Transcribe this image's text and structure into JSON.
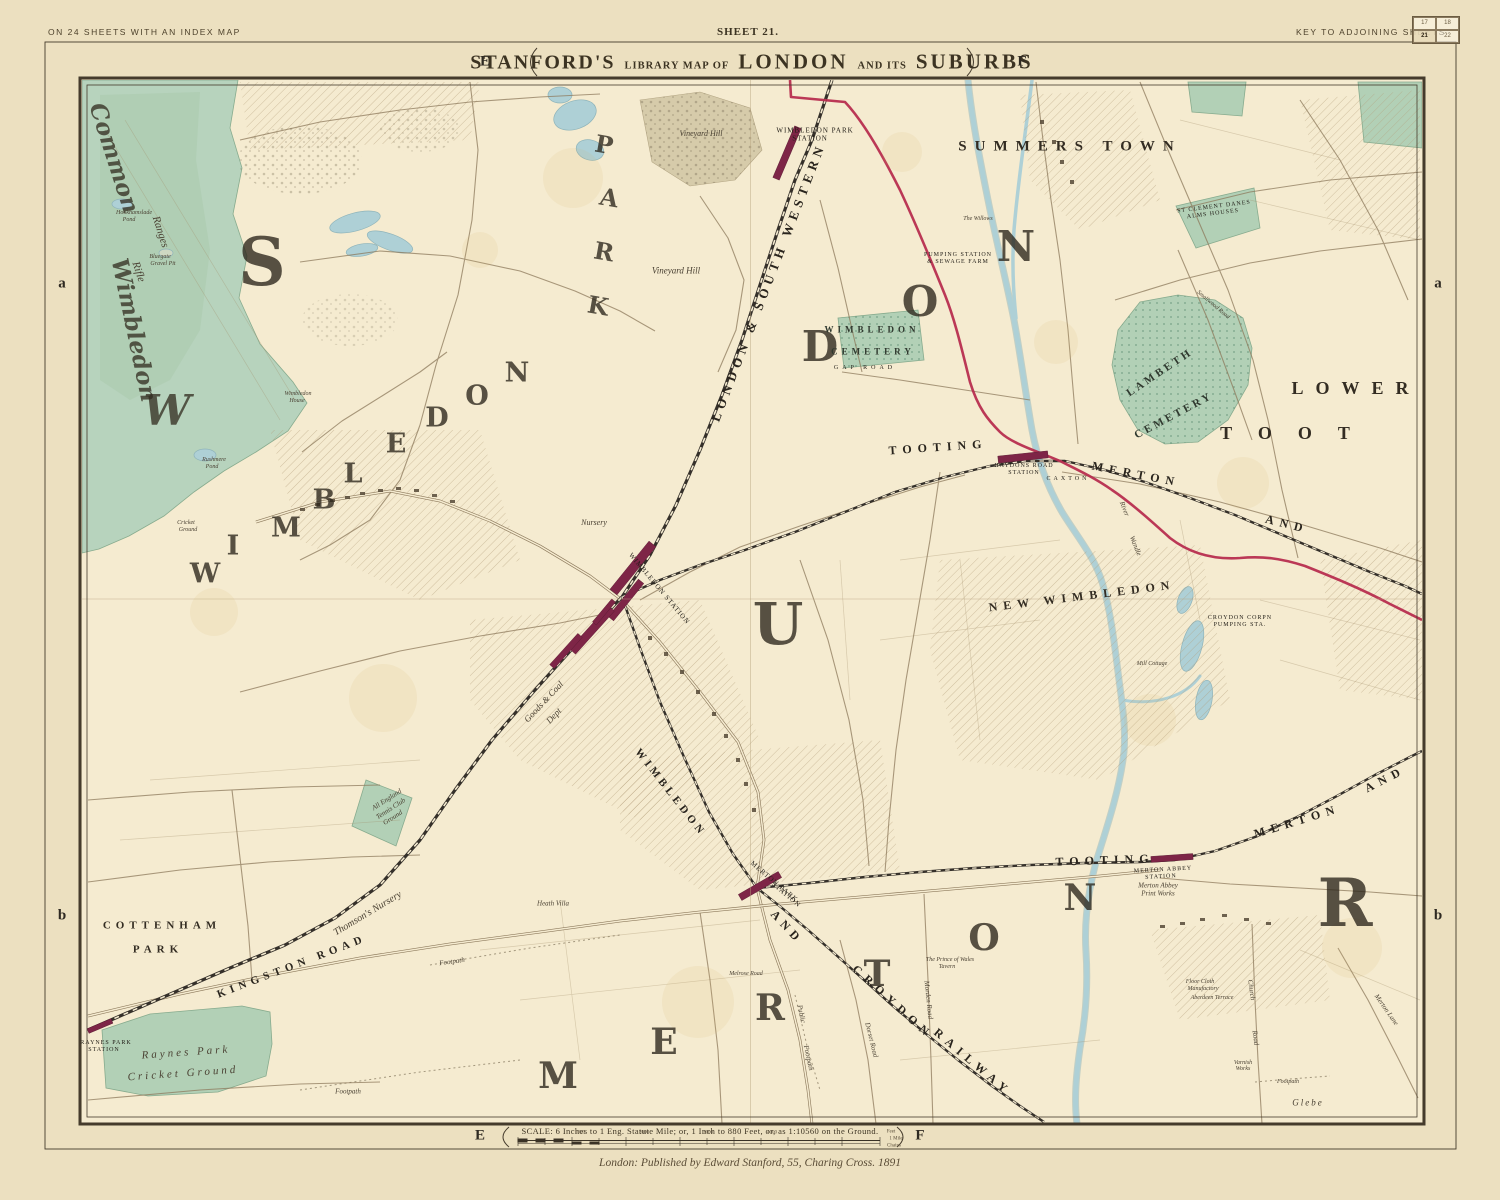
{
  "page": {
    "margin_top_left": "ON 24 SHEETS WITH AN INDEX MAP",
    "sheet_label": "SHEET 21.",
    "key_label": "KEY TO ADJOINING SHEETS",
    "key_grid": [
      "17",
      "18",
      "21",
      "22"
    ],
    "title": {
      "part1": "STANFORD'S",
      "part2": "LIBRARY MAP OF",
      "part3": "LONDON",
      "part4": "AND ITS",
      "part5": "SUBURBS"
    },
    "grid_letters": {
      "top_left": "E",
      "top_right": "F",
      "bottom_left": "E",
      "bottom_right": "F",
      "side_upper_left": "a",
      "side_upper_right": "a",
      "side_lower_left": "b",
      "side_lower_right": "b"
    },
    "scale_text": "SCALE: 6 Inches to 1 Eng. Statute Mile; or, 1 Inch to 880 Feet, or, as 1:10560 on the Ground.",
    "imprint": "London: Published by Edward Stanford, 55, Charing Cross. 1891"
  },
  "colors": {
    "paper": "#ece0c0",
    "map_paper": "#f5ebd0",
    "green": "#b2d0b6",
    "common_green": "#b7d3bd",
    "water": "#aed0d6",
    "boundary_red": "#b5284b",
    "station_maroon": "#7e2547",
    "railway_black": "#35302a",
    "ink": "#3d3528",
    "road": "#8d7a5c"
  },
  "map": {
    "labels": [
      {
        "t": "Common",
        "x": 114,
        "y": 158,
        "s": 23,
        "r": 72,
        "c": "hgi"
      },
      {
        "t": "Wimbledon",
        "x": 134,
        "y": 330,
        "s": 23,
        "r": 78,
        "c": "hgi"
      },
      {
        "t": "Rifle",
        "x": 138,
        "y": 272,
        "s": 11,
        "r": 72,
        "c": "i"
      },
      {
        "t": "Ranges",
        "x": 160,
        "y": 232,
        "s": 11,
        "r": 72,
        "c": "i"
      },
      {
        "t": "Hookhamslade",
        "x": 134,
        "y": 213,
        "s": 6,
        "c": "i"
      },
      {
        "t": "Pond",
        "x": 129,
        "y": 220,
        "s": 6,
        "c": "i"
      },
      {
        "t": "Bluegate",
        "x": 160,
        "y": 257,
        "s": 6,
        "c": "i"
      },
      {
        "t": "Gravel Pit",
        "x": 163,
        "y": 264,
        "s": 6,
        "c": "i"
      },
      {
        "t": "Rushmere",
        "x": 214,
        "y": 460,
        "s": 6,
        "c": "i"
      },
      {
        "t": "Pond",
        "x": 212,
        "y": 467,
        "s": 6,
        "c": "i"
      },
      {
        "t": "Cricket",
        "x": 186,
        "y": 523,
        "s": 6,
        "c": "i"
      },
      {
        "t": "Ground",
        "x": 188,
        "y": 530,
        "s": 6,
        "c": "i"
      },
      {
        "t": "S",
        "x": 262,
        "y": 262,
        "s": 66,
        "c": "hg",
        "n": "giant-letter"
      },
      {
        "t": "W",
        "x": 167,
        "y": 411,
        "s": 42,
        "c": "hgi",
        "n": "giant-letter"
      },
      {
        "t": "P",
        "x": 604,
        "y": 145,
        "s": 24,
        "r": 10,
        "c": "hg",
        "n": "giant-letter"
      },
      {
        "t": "A",
        "x": 609,
        "y": 198,
        "s": 24,
        "r": 10,
        "c": "hg",
        "n": "giant-letter"
      },
      {
        "t": "R",
        "x": 604,
        "y": 252,
        "s": 24,
        "r": 10,
        "c": "hg",
        "n": "giant-letter"
      },
      {
        "t": "K",
        "x": 598,
        "y": 306,
        "s": 24,
        "r": 10,
        "c": "hg",
        "n": "giant-letter"
      },
      {
        "t": "W",
        "x": 205,
        "y": 574,
        "s": 27,
        "c": "hg",
        "n": "giant-letter"
      },
      {
        "t": "I",
        "x": 233,
        "y": 546,
        "s": 27,
        "c": "hg",
        "n": "giant-letter"
      },
      {
        "t": "M",
        "x": 286,
        "y": 528,
        "s": 27,
        "c": "hg",
        "n": "giant-letter"
      },
      {
        "t": "B",
        "x": 324,
        "y": 500,
        "s": 27,
        "c": "hg",
        "n": "giant-letter"
      },
      {
        "t": "L",
        "x": 353,
        "y": 474,
        "s": 27,
        "c": "hg",
        "n": "giant-letter"
      },
      {
        "t": "E",
        "x": 396,
        "y": 444,
        "s": 27,
        "c": "hg",
        "n": "giant-letter"
      },
      {
        "t": "D",
        "x": 437,
        "y": 418,
        "s": 27,
        "c": "hg",
        "n": "giant-letter"
      },
      {
        "t": "O",
        "x": 477,
        "y": 396,
        "s": 27,
        "c": "hg",
        "n": "giant-letter"
      },
      {
        "t": "N",
        "x": 517,
        "y": 373,
        "s": 27,
        "c": "hg",
        "n": "giant-letter"
      },
      {
        "t": "U",
        "x": 778,
        "y": 624,
        "s": 58,
        "c": "hg",
        "n": "giant-letter"
      },
      {
        "t": "D",
        "x": 820,
        "y": 347,
        "s": 42,
        "c": "hg",
        "n": "giant-letter"
      },
      {
        "t": "O",
        "x": 920,
        "y": 302,
        "s": 42,
        "c": "hg",
        "n": "giant-letter"
      },
      {
        "t": "N",
        "x": 1016,
        "y": 247,
        "s": 42,
        "c": "hg",
        "n": "giant-letter"
      },
      {
        "t": "R",
        "x": 1345,
        "y": 903,
        "s": 66,
        "c": "hg",
        "n": "giant-letter"
      },
      {
        "t": "M",
        "x": 558,
        "y": 1076,
        "s": 36,
        "c": "hg",
        "n": "giant-letter"
      },
      {
        "t": "E",
        "x": 664,
        "y": 1042,
        "s": 36,
        "c": "hg",
        "n": "giant-letter"
      },
      {
        "t": "R",
        "x": 770,
        "y": 1008,
        "s": 36,
        "c": "hg",
        "n": "giant-letter"
      },
      {
        "t": "T",
        "x": 877,
        "y": 974,
        "s": 36,
        "c": "hg",
        "n": "giant-letter"
      },
      {
        "t": "O",
        "x": 984,
        "y": 938,
        "s": 36,
        "c": "hg",
        "n": "giant-letter"
      },
      {
        "t": "N",
        "x": 1080,
        "y": 898,
        "s": 36,
        "c": "hg",
        "n": "giant-letter"
      },
      {
        "t": "SUMMERS TOWN",
        "x": 1070,
        "y": 147,
        "s": 15,
        "c": "sp",
        "ls": 8
      },
      {
        "t": "LOWER",
        "x": 1356,
        "y": 388,
        "s": 18,
        "c": "sp",
        "ls": 12
      },
      {
        "t": "TOOT",
        "x": 1298,
        "y": 433,
        "s": 18,
        "c": "sp",
        "ls": 26
      },
      {
        "t": "NEW WIMBLEDON",
        "x": 1082,
        "y": 596,
        "s": 12,
        "r": -7,
        "c": "sp",
        "ls": 6
      },
      {
        "t": "COTTENHAM",
        "x": 162,
        "y": 926,
        "s": 11,
        "c": "sp",
        "ls": 5
      },
      {
        "t": "PARK",
        "x": 158,
        "y": 950,
        "s": 11,
        "c": "sp",
        "ls": 5
      },
      {
        "t": "LONDON & SOUTH WESTERN",
        "x": 768,
        "y": 282,
        "s": 13,
        "r": -69,
        "c": "rw",
        "ls": 5
      },
      {
        "t": "KINGSTON ROAD",
        "x": 292,
        "y": 967,
        "s": 11,
        "r": -21,
        "c": "rw",
        "ls": 5
      },
      {
        "t": "TOOTING",
        "x": 938,
        "y": 447,
        "s": 12,
        "r": -4,
        "c": "rw",
        "ls": 6
      },
      {
        "t": "MERTON",
        "x": 1136,
        "y": 474,
        "s": 12,
        "r": 11,
        "c": "rw",
        "ls": 6
      },
      {
        "t": "AND",
        "x": 1287,
        "y": 524,
        "s": 12,
        "r": 14,
        "c": "rw",
        "ls": 6
      },
      {
        "t": "TOOTING",
        "x": 1105,
        "y": 860,
        "s": 12,
        "r": -2,
        "c": "rw",
        "ls": 6
      },
      {
        "t": "MERTON",
        "x": 1297,
        "y": 821,
        "s": 12,
        "r": -17,
        "c": "rw",
        "ls": 6
      },
      {
        "t": "AND",
        "x": 1385,
        "y": 779,
        "s": 12,
        "r": -27,
        "c": "rw",
        "ls": 6
      },
      {
        "t": "AND",
        "x": 787,
        "y": 927,
        "s": 12,
        "r": 47,
        "c": "rw",
        "ls": 5
      },
      {
        "t": "CROYDON",
        "x": 893,
        "y": 1002,
        "s": 12,
        "r": 42,
        "c": "rw",
        "ls": 6
      },
      {
        "t": "RAILWAY",
        "x": 973,
        "y": 1062,
        "s": 12,
        "r": 40,
        "c": "rw",
        "ls": 6
      },
      {
        "t": "WIMBLEDON",
        "x": 670,
        "y": 793,
        "s": 11,
        "r": 52,
        "c": "rw",
        "ls": 4
      },
      {
        "t": "WIMBLEDON PARK",
        "x": 815,
        "y": 131,
        "s": 7,
        "c": "st",
        "n": "station-label"
      },
      {
        "t": "STATION",
        "x": 810,
        "y": 139,
        "s": 7,
        "c": "st",
        "n": "station-label"
      },
      {
        "t": "WIMBLEDON STATION",
        "x": 659,
        "y": 589,
        "s": 7,
        "r": 50,
        "c": "st",
        "n": "station-label"
      },
      {
        "t": "HAYDONS ROAD",
        "x": 1024,
        "y": 466,
        "s": 6,
        "c": "st",
        "n": "station-label"
      },
      {
        "t": "STATION",
        "x": 1024,
        "y": 473,
        "s": 6,
        "c": "st",
        "n": "station-label"
      },
      {
        "t": "MERTON ABBEY",
        "x": 1163,
        "y": 870,
        "s": 6,
        "r": -3,
        "c": "st",
        "n": "station-label"
      },
      {
        "t": "STATION",
        "x": 1161,
        "y": 877,
        "s": 6,
        "r": -3,
        "c": "st",
        "n": "station-label"
      },
      {
        "t": "MERTON PARK",
        "x": 774,
        "y": 882,
        "s": 7,
        "r": 40,
        "c": "st",
        "n": "station-label"
      },
      {
        "t": "STATION",
        "x": 786,
        "y": 895,
        "s": 7,
        "r": 40,
        "c": "st",
        "n": "station-label"
      },
      {
        "t": "RAYNES PARK",
        "x": 106,
        "y": 1043,
        "s": 6,
        "c": "st",
        "n": "station-label"
      },
      {
        "t": "STATION",
        "x": 104,
        "y": 1050,
        "s": 6,
        "c": "st",
        "n": "station-label"
      },
      {
        "t": "PUMPING STATION",
        "x": 958,
        "y": 255,
        "s": 6,
        "c": "st"
      },
      {
        "t": "& SEWAGE FARM",
        "x": 958,
        "y": 262,
        "s": 6,
        "c": "st"
      },
      {
        "t": "CROYDON CORPN",
        "x": 1240,
        "y": 618,
        "s": 6,
        "c": "st"
      },
      {
        "t": "PUMPING STA.",
        "x": 1240,
        "y": 625,
        "s": 6,
        "c": "st"
      },
      {
        "t": "WIMBLEDON",
        "x": 872,
        "y": 330,
        "s": 9,
        "c": "cem",
        "ls": 4
      },
      {
        "t": "CEMETERY",
        "x": 873,
        "y": 352,
        "s": 9,
        "c": "cem",
        "ls": 4
      },
      {
        "t": "LAMBETH",
        "x": 1160,
        "y": 373,
        "s": 11,
        "r": -34,
        "c": "cem",
        "ls": 3
      },
      {
        "t": "CEMETERY",
        "x": 1174,
        "y": 416,
        "s": 11,
        "r": -28,
        "c": "cem",
        "ls": 3
      },
      {
        "t": "ST CLEMENT DANES",
        "x": 1214,
        "y": 207,
        "s": 6,
        "r": -7,
        "c": "st"
      },
      {
        "t": "ALMS HOUSES",
        "x": 1213,
        "y": 214,
        "s": 6,
        "r": -7,
        "c": "st"
      },
      {
        "t": "Vineyard Hill",
        "x": 676,
        "y": 271,
        "s": 9,
        "c": "i"
      },
      {
        "t": "Vineyard Hill",
        "x": 701,
        "y": 134,
        "s": 8,
        "c": "i"
      },
      {
        "t": "Nursery",
        "x": 594,
        "y": 523,
        "s": 8,
        "c": "i"
      },
      {
        "t": "Thomson's Nursery",
        "x": 368,
        "y": 914,
        "s": 10,
        "r": -31,
        "c": "i"
      },
      {
        "t": "Goods & Coal",
        "x": 544,
        "y": 702,
        "s": 9,
        "r": -47,
        "c": "i"
      },
      {
        "t": "Dept",
        "x": 554,
        "y": 716,
        "s": 9,
        "r": -47,
        "c": "i"
      },
      {
        "t": "Heath Villa",
        "x": 553,
        "y": 904,
        "s": 7,
        "c": "i"
      },
      {
        "t": "All England",
        "x": 387,
        "y": 800,
        "s": 7,
        "r": -33,
        "c": "i"
      },
      {
        "t": "Tennis Club",
        "x": 391,
        "y": 809,
        "s": 7,
        "r": -33,
        "c": "i"
      },
      {
        "t": "Ground",
        "x": 393,
        "y": 818,
        "s": 7,
        "r": -33,
        "c": "i"
      },
      {
        "t": "Raynes Park",
        "x": 186,
        "y": 1053,
        "s": 11,
        "r": -4,
        "c": "i",
        "ls": 3
      },
      {
        "t": "Cricket Ground",
        "x": 183,
        "y": 1074,
        "s": 11,
        "r": -4,
        "c": "i",
        "ls": 3
      },
      {
        "t": "The Willows",
        "x": 978,
        "y": 219,
        "s": 6,
        "c": "i"
      },
      {
        "t": "The Prince of Wales",
        "x": 950,
        "y": 960,
        "s": 6,
        "c": "i"
      },
      {
        "t": "Tavern",
        "x": 947,
        "y": 967,
        "s": 6,
        "c": "i"
      },
      {
        "t": "Merton Abbey",
        "x": 1158,
        "y": 886,
        "s": 7,
        "c": "i"
      },
      {
        "t": "Print Works",
        "x": 1158,
        "y": 894,
        "s": 7,
        "c": "i"
      },
      {
        "t": "Floor Cloth",
        "x": 1200,
        "y": 982,
        "s": 6,
        "c": "i"
      },
      {
        "t": "Manufactory",
        "x": 1203,
        "y": 989,
        "s": 6,
        "c": "i"
      },
      {
        "t": "Aberdeen Terrace",
        "x": 1212,
        "y": 998,
        "s": 6,
        "c": "i"
      },
      {
        "t": "Varnish",
        "x": 1243,
        "y": 1063,
        "s": 6,
        "c": "i"
      },
      {
        "t": "Works",
        "x": 1243,
        "y": 1069,
        "s": 6,
        "c": "i"
      },
      {
        "t": "Glebe",
        "x": 1308,
        "y": 1103,
        "s": 9,
        "c": "i",
        "ls": 2
      },
      {
        "t": "Footpath",
        "x": 1288,
        "y": 1082,
        "s": 6,
        "c": "i"
      },
      {
        "t": "Footpath",
        "x": 348,
        "y": 1092,
        "s": 7,
        "c": "i"
      },
      {
        "t": "Footpath",
        "x": 452,
        "y": 962,
        "s": 7,
        "r": -8,
        "c": "i"
      },
      {
        "t": "Public",
        "x": 801,
        "y": 1014,
        "s": 7,
        "r": 78,
        "c": "i"
      },
      {
        "t": "Footpath",
        "x": 808,
        "y": 1058,
        "s": 7,
        "r": 78,
        "c": "i"
      },
      {
        "t": "Church",
        "x": 1251,
        "y": 990,
        "s": 7,
        "r": 82,
        "c": "i"
      },
      {
        "t": "Road",
        "x": 1255,
        "y": 1038,
        "s": 7,
        "r": 82,
        "c": "i"
      },
      {
        "t": "Merton Lane",
        "x": 1386,
        "y": 1010,
        "s": 7,
        "r": 55,
        "c": "i"
      },
      {
        "t": "Morden Road",
        "x": 928,
        "y": 1000,
        "s": 7,
        "r": 84,
        "c": "i"
      },
      {
        "t": "Dorset Road",
        "x": 871,
        "y": 1040,
        "s": 7,
        "r": 76,
        "c": "i"
      },
      {
        "t": "Melrose Road",
        "x": 746,
        "y": 974,
        "s": 6,
        "c": "i"
      },
      {
        "t": "River",
        "x": 1124,
        "y": 509,
        "s": 7,
        "r": 68,
        "c": "i"
      },
      {
        "t": "Wandle",
        "x": 1135,
        "y": 546,
        "s": 7,
        "r": 68,
        "c": "i"
      },
      {
        "t": "Mill Cottage",
        "x": 1152,
        "y": 664,
        "s": 6,
        "c": "i"
      },
      {
        "t": "CAXTON",
        "x": 1068,
        "y": 479,
        "s": 6,
        "c": "st",
        "ls": 3
      },
      {
        "t": "GAP ROAD",
        "x": 865,
        "y": 368,
        "s": 6,
        "c": "st",
        "ls": 4
      },
      {
        "t": "Smallwood Road",
        "x": 1213,
        "y": 305,
        "s": 6,
        "r": 40,
        "c": "i"
      },
      {
        "t": "Wimbledon",
        "x": 298,
        "y": 394,
        "s": 6,
        "c": "i"
      },
      {
        "t": "House",
        "x": 297,
        "y": 401,
        "s": 6,
        "c": "i"
      },
      {
        "t": "1000",
        "x": 580,
        "y": 1133,
        "s": 5,
        "c": "tk",
        "n": "scale-tick"
      },
      {
        "t": "2000",
        "x": 644,
        "y": 1133,
        "s": 5,
        "c": "tk",
        "n": "scale-tick"
      },
      {
        "t": "3000",
        "x": 708,
        "y": 1133,
        "s": 5,
        "c": "tk",
        "n": "scale-tick"
      },
      {
        "t": "4000",
        "x": 772,
        "y": 1133,
        "s": 5,
        "c": "tk",
        "n": "scale-tick"
      },
      {
        "t": "Feet",
        "x": 891,
        "y": 1132,
        "s": 5,
        "c": "tk",
        "n": "scale-tick"
      },
      {
        "t": "1 Mile",
        "x": 896,
        "y": 1139,
        "s": 5,
        "c": "tk",
        "n": "scale-tick"
      },
      {
        "t": "Chains",
        "x": 894,
        "y": 1146,
        "s": 5,
        "c": "tk",
        "n": "scale-tick"
      }
    ]
  }
}
